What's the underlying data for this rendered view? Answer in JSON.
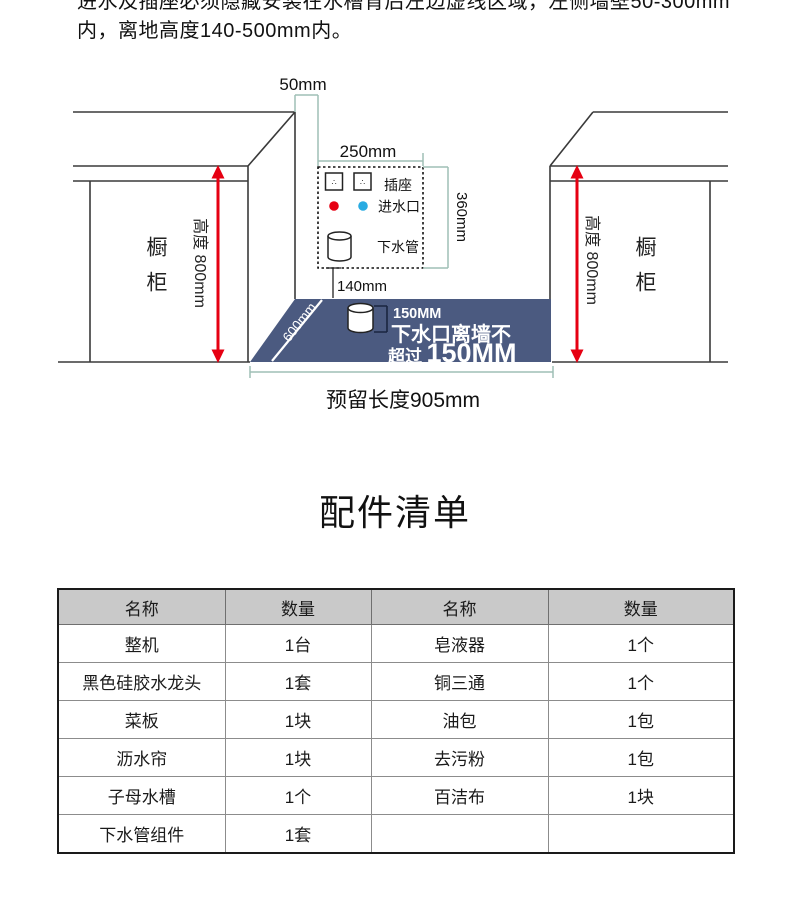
{
  "page": {
    "intro_line1": "进水及插座必须隐藏安装在水槽背后左边虚线区域，左侧墙壁50-300mm",
    "intro_line2": "内，离地高度140-500mm内。",
    "section_title": "配件清单"
  },
  "diagram": {
    "dim_top_gap": "50mm",
    "dim_box_width": "250mm",
    "dim_box_height": "360mm",
    "dim_box_floor": "140mm",
    "dim_recess_depth": "600mm",
    "socket_label": "插座",
    "socket_mark": "∴",
    "inlet_label": "进水口",
    "drain_label": "下水管",
    "cabinet_label": "橱柜",
    "height_label": "高度 800mm",
    "drain_dim": "150MM",
    "drain_note_line1": "下水口离墙不",
    "drain_note_prefix": "超过",
    "drain_note_value": "150MM",
    "reserved_length": "预留长度905mm",
    "colors": {
      "floor_blue": "#4b5a80",
      "dim_teal": "#9fbfb6",
      "arrow_red": "#e60012",
      "inlet_dot_blue": "#29abe2",
      "hot_dot_red": "#e60012"
    }
  },
  "parts_table": {
    "headers": [
      "名称",
      "数量",
      "名称",
      "数量"
    ],
    "rows": [
      [
        "整机",
        "1台",
        "皂液器",
        "1个"
      ],
      [
        "黑色硅胶水龙头",
        "1套",
        "铜三通",
        "1个"
      ],
      [
        "菜板",
        "1块",
        "油包",
        "1包"
      ],
      [
        "沥水帘",
        "1块",
        "去污粉",
        "1包"
      ],
      [
        "子母水槽",
        "1个",
        "百洁布",
        "1块"
      ],
      [
        "下水管组件",
        "1套",
        "",
        ""
      ]
    ]
  }
}
